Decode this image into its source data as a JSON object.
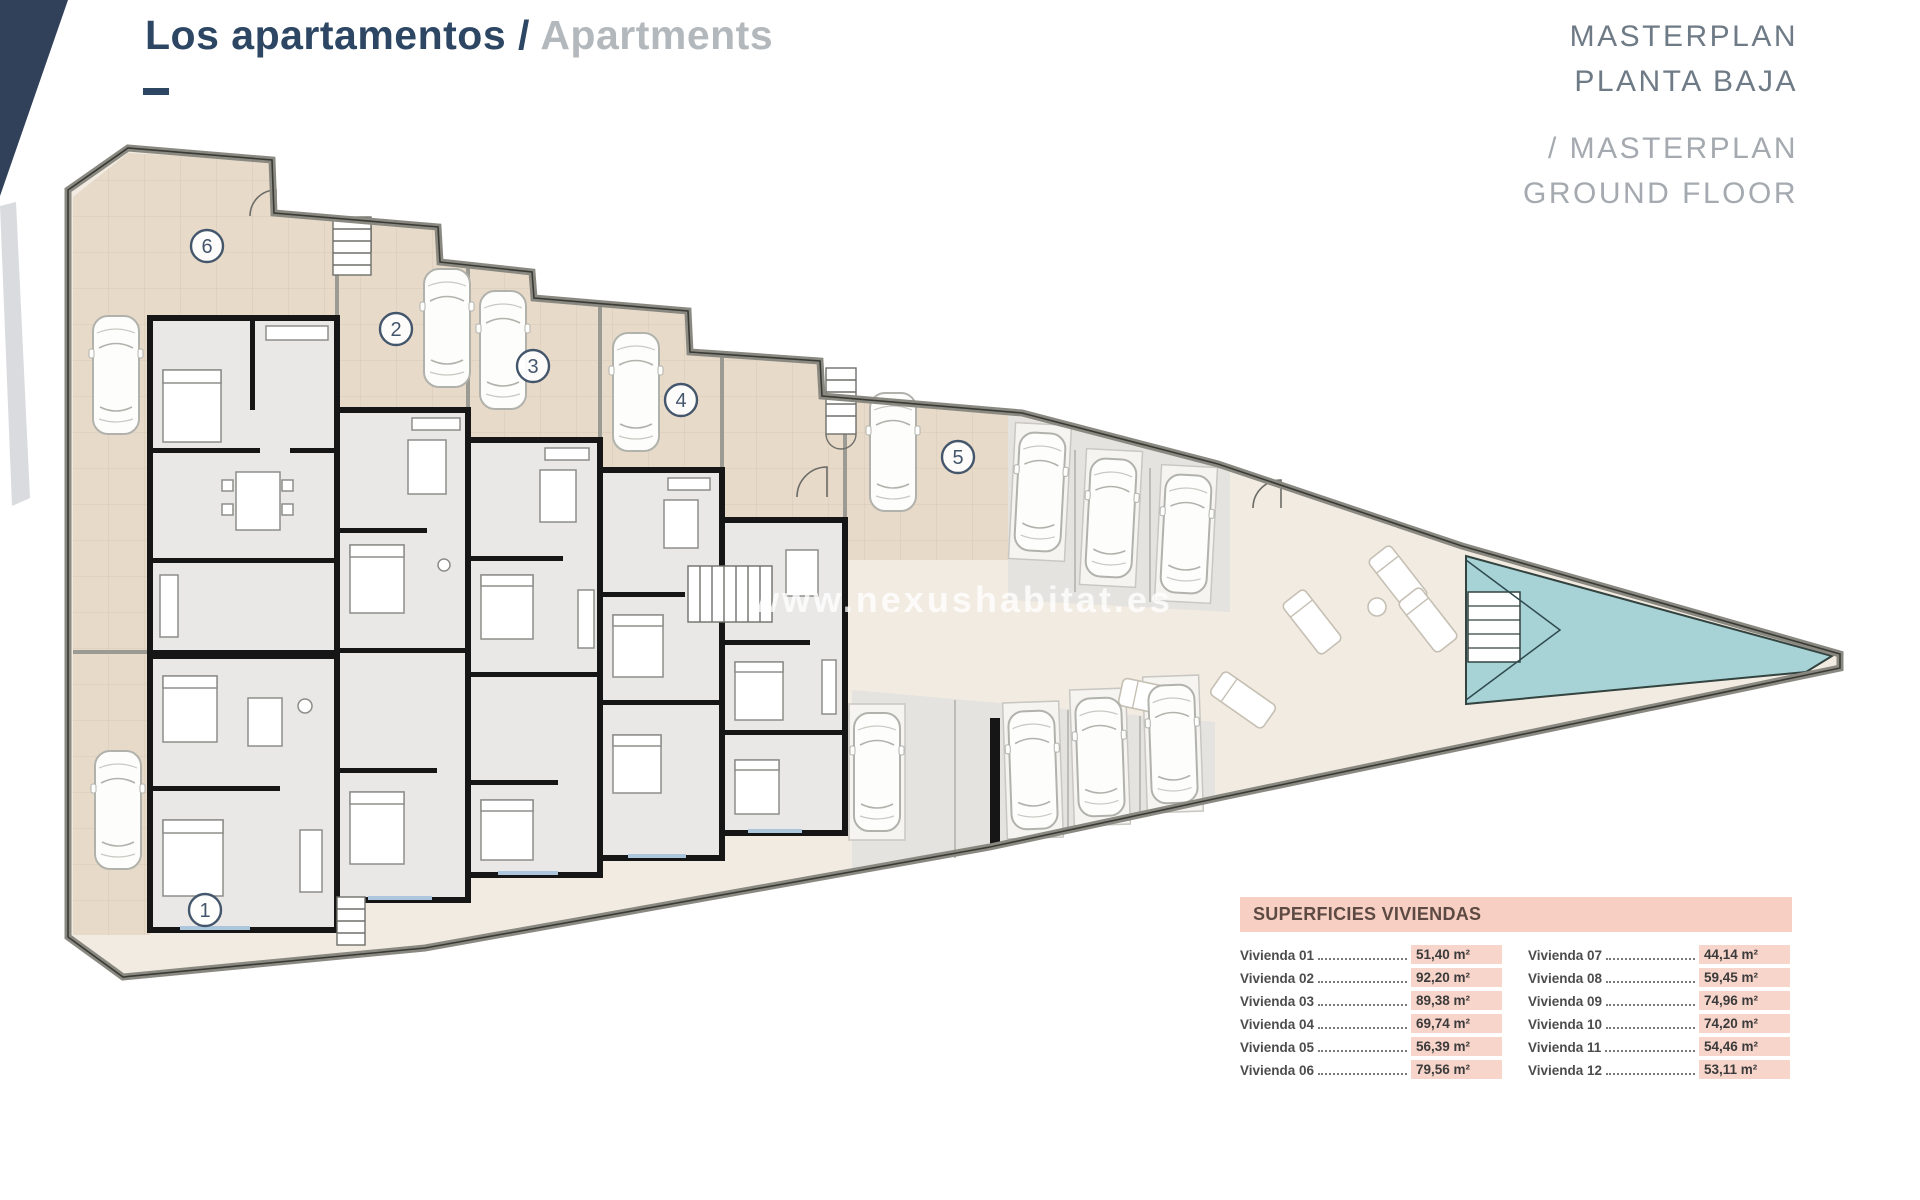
{
  "page": {
    "title_primary": "Los apartamentos /",
    "title_secondary": "Apartments"
  },
  "masterplan_heading": {
    "line1": "MASTERPLAN",
    "line2": "PLANTA BAJA",
    "line3": "/ MASTERPLAN",
    "line4": "GROUND FLOOR"
  },
  "watermark": "www.nexushabitat.es",
  "plan": {
    "unit_markers": [
      {
        "label": "1",
        "x": 205,
        "y": 910
      },
      {
        "label": "2",
        "x": 396,
        "y": 329
      },
      {
        "label": "3",
        "x": 533,
        "y": 366
      },
      {
        "label": "4",
        "x": 681,
        "y": 400
      },
      {
        "label": "5",
        "x": 958,
        "y": 457
      },
      {
        "label": "6",
        "x": 207,
        "y": 246
      }
    ],
    "icons": {
      "car_icon": "car-top-view",
      "lounger_icon": "sun-lounger",
      "stairs_icon": "stairs",
      "pool_icon": "swimming-pool"
    }
  },
  "areas_table": {
    "title": "SUPERFICIES VIVIENDAS",
    "rows_left": [
      {
        "label": "Vivienda 01",
        "value": "51,40 m²"
      },
      {
        "label": "Vivienda 02",
        "value": "92,20 m²"
      },
      {
        "label": "Vivienda 03",
        "value": "89,38 m²"
      },
      {
        "label": "Vivienda 04",
        "value": "69,74 m²"
      },
      {
        "label": "Vivienda 05",
        "value": "56,39 m²"
      },
      {
        "label": "Vivienda 06",
        "value": "79,56 m²"
      }
    ],
    "rows_right": [
      {
        "label": "Vivienda 07",
        "value": "44,14 m²"
      },
      {
        "label": "Vivienda 08",
        "value": "59,45 m²"
      },
      {
        "label": "Vivienda 09",
        "value": "74,96 m²"
      },
      {
        "label": "Vivienda 10",
        "value": "74,20 m²"
      },
      {
        "label": "Vivienda 11",
        "value": "54,46 m²"
      },
      {
        "label": "Vivienda 12",
        "value": "53,11 m²"
      }
    ]
  },
  "colors": {
    "accent_navy": "#2c4663",
    "title_gray": "#b3b8bc",
    "masterplan_dark": "#6e7a85",
    "masterplan_light": "#a4aaaf",
    "table_pink": "#f7cfc3",
    "value_pink": "#f8d5ca",
    "table_text": "#5c4a43",
    "terrace_beige": "#e7dac9",
    "site_pale": "#f2ebe1",
    "interior_gray": "#e9e8e6",
    "parking_gray": "#e4e3e0",
    "pool_teal": "#a7d2d6",
    "wall_black": "#161616",
    "marker_blue": "#44566b"
  }
}
